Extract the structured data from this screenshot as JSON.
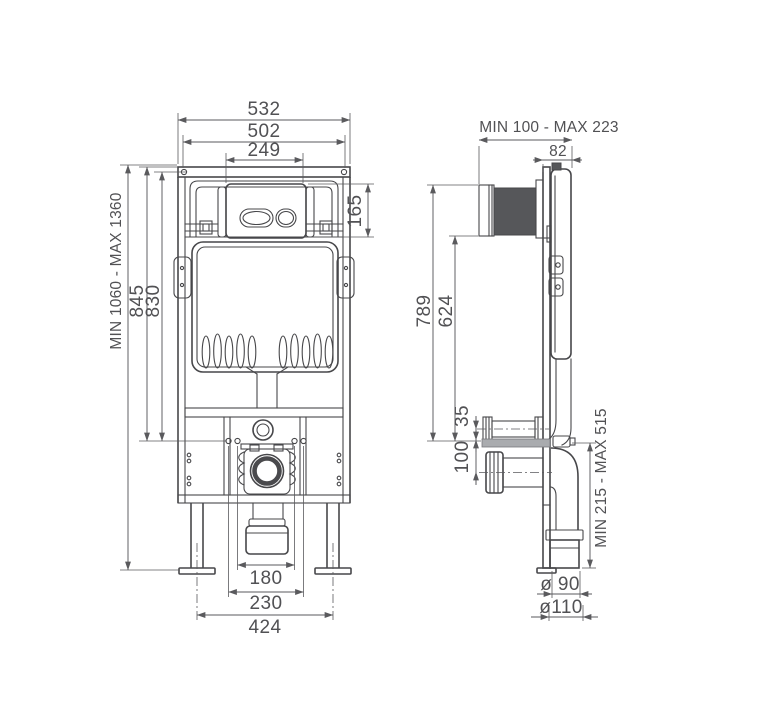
{
  "front": {
    "frame_width": "532",
    "inner_width": "502",
    "plate_width": "249",
    "plate_height": "165",
    "total_height": "MIN 1060 - MAX 1360",
    "height_845": "845",
    "height_830": "830",
    "outlet_width": "180",
    "fixing_width": "230",
    "feet_span": "424"
  },
  "side": {
    "depth_range": "MIN 100 - MAX 223",
    "frame_depth": "82",
    "height_789": "789",
    "height_624": "624",
    "pipe_offset": "35",
    "outlet_height": "100",
    "outlet_range": "MIN 215 - MAX 515",
    "dia_90": "ø 90",
    "dia_110": "ø110"
  }
}
